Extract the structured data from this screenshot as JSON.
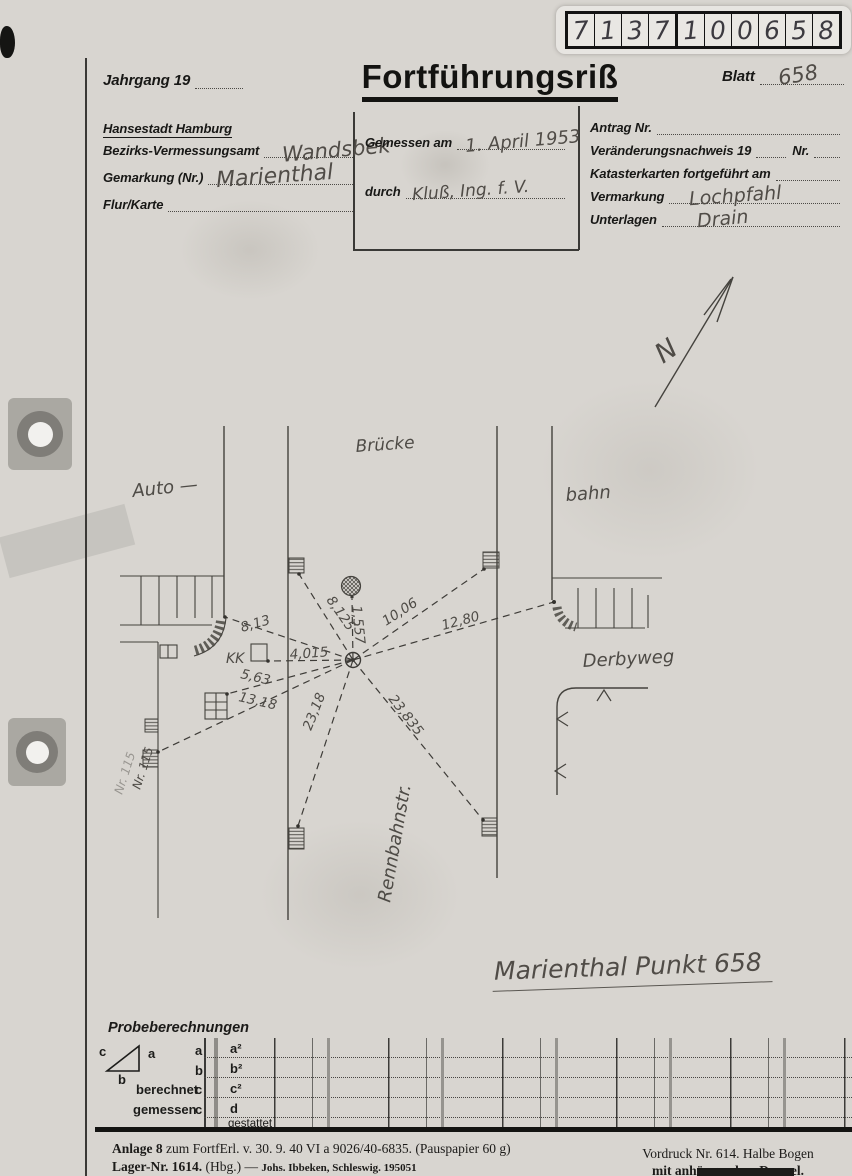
{
  "stamp": {
    "digits": [
      "7",
      "1",
      "3",
      "7",
      "1",
      "0",
      "0",
      "6",
      "5",
      "8"
    ]
  },
  "header": {
    "jahrgang_label": "Jahrgang 19",
    "title": "Fortführungsriß",
    "blatt_label": "Blatt",
    "blatt_value": "658"
  },
  "form": {
    "city": "Hansestadt Hamburg",
    "left": [
      {
        "label": "Bezirks-Vermessungsamt",
        "value": "Wandsbek"
      },
      {
        "label": "Gemarkung (Nr.)",
        "value": "Marienthal"
      },
      {
        "label": "Flur/Karte",
        "value": ""
      }
    ],
    "middle": [
      {
        "label": "Gemessen am",
        "value": "1. April 1953"
      },
      {
        "label": "durch",
        "value": "Kluß, Ing. f. V."
      }
    ],
    "right": {
      "antrag_label": "Antrag Nr.",
      "veraenderung_label": "Veränderungsnachweis 19",
      "veraenderung_nr_label": "Nr.",
      "kataster_label": "Katasterkarten fortgeführt am",
      "vermarkung_label": "Vermarkung",
      "vermarkung_value": "Lochpfahl",
      "unterlagen_label": "Unterlagen",
      "unterlagen_value": "Drain"
    }
  },
  "sketch": {
    "north_label": "N",
    "labels": {
      "bruecke": "Brücke",
      "auto": "Auto —",
      "bahn": "bahn",
      "derbyweg": "Derbyweg",
      "rennbahnstr": "Rennbahnstr.",
      "nr115": "Nr. 115",
      "kk": "KK"
    },
    "measurements": {
      "to_curb_left": "8,13",
      "to_road_left_top": "8,125",
      "to_tree": "1,557",
      "to_road_right_top": "10,06",
      "to_curb_right": "12,80",
      "to_kk_box": "4,015",
      "to_building_left": "5,63",
      "to_mark_left": "13,18",
      "to_road_left_bottom": "23,18",
      "to_road_right_bottom": "23,835"
    },
    "caption": "Marienthal Punkt 658"
  },
  "probe": {
    "title": "Probeberechnungen",
    "tri_a": "a",
    "tri_b": "b",
    "tri_c": "c",
    "row_a": "a",
    "row_b": "b",
    "berechnet": "berechnet",
    "gemessen": "gemessen",
    "letter_c1": "c",
    "letter_c2": "c",
    "cell_a2": "a²",
    "cell_b2": "b²",
    "cell_c2": "c²",
    "cell_d": "d",
    "gestattet": "gestattet"
  },
  "footer": {
    "left1_bold": "Anlage 8",
    "left1_rest": " zum FortfErl. v. 30. 9. 40  VI a 9026/40-6835.  (Pauspapier 60 g)",
    "left2_bold": "Lager-Nr. 1614.",
    "left2_mid": " (Hbg.)  — ",
    "left2_small": "Johs. Ibbeken, Schleswig.  195051",
    "right1": "Vordruck Nr. 614.  Halbe Bogen",
    "right2": "mit anhängendem Doppel."
  }
}
